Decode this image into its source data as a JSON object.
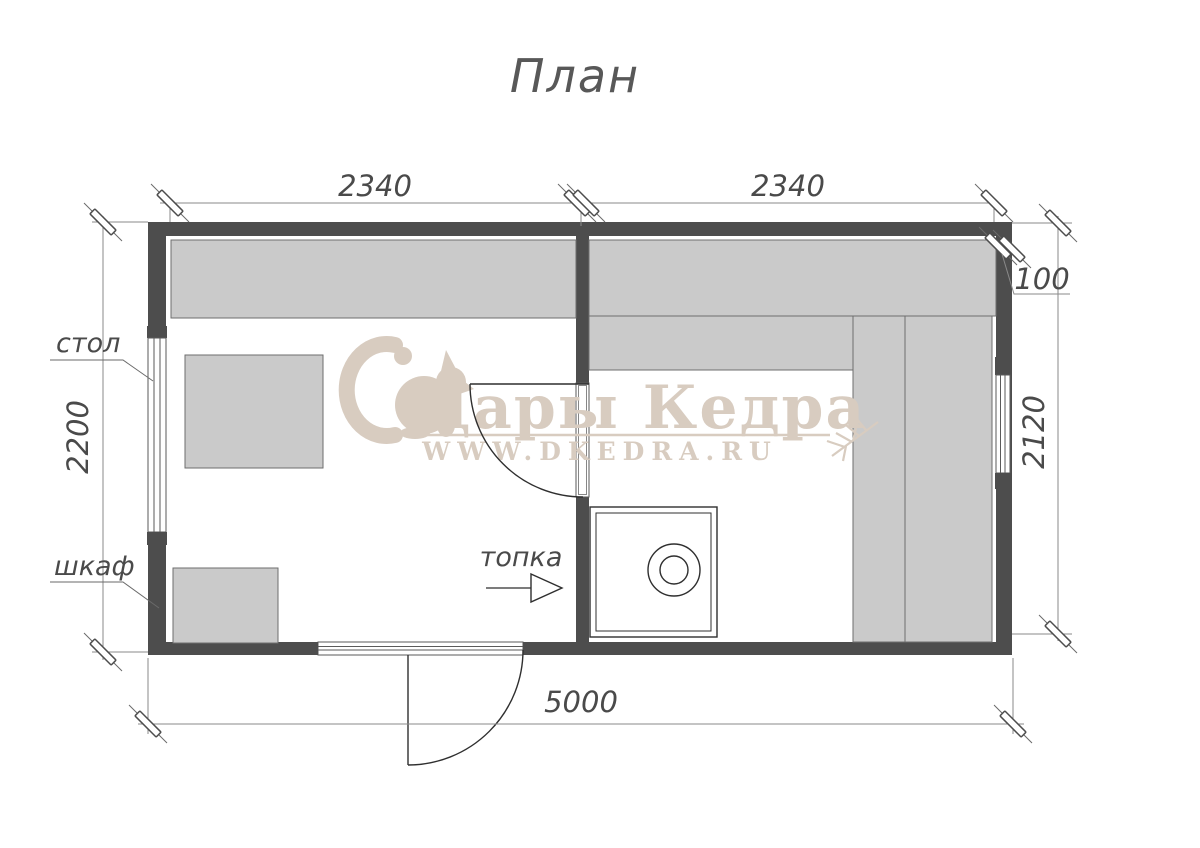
{
  "title": "План",
  "plan": {
    "labels": {
      "table": "стол",
      "cabinet": "шкаф",
      "firebox": "топка"
    },
    "dimensions": {
      "top_left": "2340",
      "top_right": "2340",
      "left_height": "2200",
      "right_height": "2120",
      "wall_thickness": "100",
      "total_width": "5000"
    }
  },
  "watermark": {
    "brand": "Дары Кедра",
    "website": "WWW.DKEDRA.RU",
    "color": "#d8ccc0"
  },
  "colors": {
    "wall": "#4d4d4d",
    "bench_fill": "#cacaca",
    "bench_stroke": "#6e6e6e",
    "dimension_line": "#8a8a8a",
    "text": "#4a4a4a",
    "background": "#ffffff"
  }
}
